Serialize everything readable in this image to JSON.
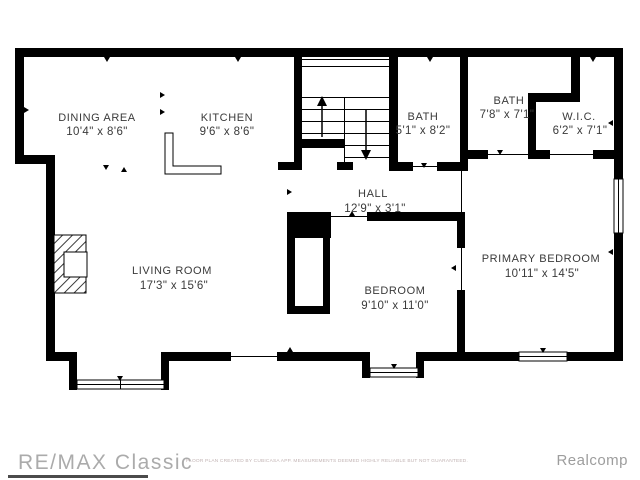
{
  "plan": {
    "rooms": [
      {
        "name": "DINING AREA",
        "dims": "10'4\" x 8'6\""
      },
      {
        "name": "KITCHEN",
        "dims": "9'6\" x 8'6\""
      },
      {
        "name": "BATH",
        "dims": "5'1\" x 8'2\""
      },
      {
        "name": "BATH",
        "dims": "7'8\" x 7'1\""
      },
      {
        "name": "W.I.C.",
        "dims": "6'2\" x 7'1\""
      },
      {
        "name": "HALL",
        "dims": "12'9\" x 3'1\""
      },
      {
        "name": "LIVING ROOM",
        "dims": "17'3\" x 15'6\""
      },
      {
        "name": "BEDROOM",
        "dims": "9'10\" x 11'0\""
      },
      {
        "name": "PRIMARY BEDROOM",
        "dims": "10'11\" x 14'5\""
      }
    ],
    "features": [
      "staircase-up-down",
      "fireplace",
      "kitchen-counter",
      "bay-window-living-room",
      "bay-window-bedroom",
      "window-primary-south",
      "window-primary-east"
    ]
  },
  "footer": {
    "brand": "RE/MAX Classic",
    "disclaimer": "FLOOR PLAN CREATED BY CUBICASA APP. MEASUREMENTS DEEMED HIGHLY RELIABLE BUT NOT GUARANTEED.",
    "attribution": "Realcomp"
  },
  "colors": {
    "wall": "#000000",
    "room_label": "#3a3a3a",
    "brand_watermark": "#ababab",
    "attribution": "#9d9d9d",
    "disclaimer": "#c2b3b3",
    "background": "#ffffff"
  }
}
